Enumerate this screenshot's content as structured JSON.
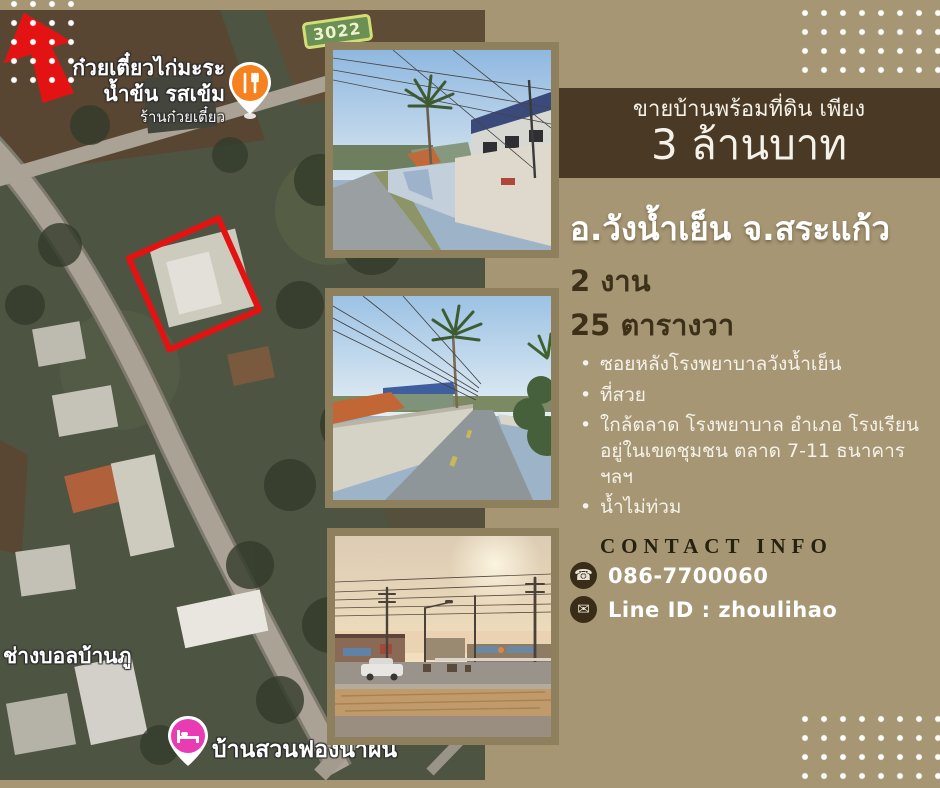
{
  "poster": {
    "header": {
      "subtitle": "ขายบ้านพร้อมที่ดิน เพียง",
      "title": "3 ล้านบาท"
    },
    "location": "อ.วังน้ำเย็น จ.สระแก้ว",
    "area_line1": "2 งาน",
    "area_line2": "25 ตารางวา",
    "features": [
      "ซอยหลังโรงพยาบาลวังน้ำเย็น",
      "ที่สวย",
      "ใกล้ตลาด โรงพยาบาล อำเภอ โรงเรียน อยู่ในเขตชุมชน ตลาด 7-11 ธนาคาร ฯลฯ",
      "น้ำไม่ท่วม"
    ],
    "contact": {
      "heading": "CONTACT INFO",
      "phone_icon": "phone-icon",
      "phone": "086-7700060",
      "line_icon": "envelope-icon",
      "line": "Line ID : zhoulihao"
    }
  },
  "map": {
    "road_sign": "3022",
    "labels": {
      "noodle_line1": "ก๋วยเตี๋ยวไก่มะระ",
      "noodle_line2": "น้ำข้น รสเข้ม",
      "noodle_line3": "ร้านก๋วยเตี๋ยว",
      "football_shop": "ช่างบอลบ้านภู",
      "resort": "บ้านสวนฟองน้ำฝน"
    },
    "icons": {
      "restaurant_pin": "restaurant-pin",
      "lodging_pin": "lodging-pin",
      "plot_marker": "red-plot-rectangle",
      "arrow_marker": "red-arrow"
    }
  },
  "colors": {
    "panel_tan": "#a69674",
    "band_brown": "#4a3a25",
    "dark_text": "#3c3019",
    "accent_red": "#e41313",
    "restaurant_orange": "#f5821f",
    "lodging_pink": "#e93cb4",
    "photo_frame": "#8e7f5d"
  }
}
